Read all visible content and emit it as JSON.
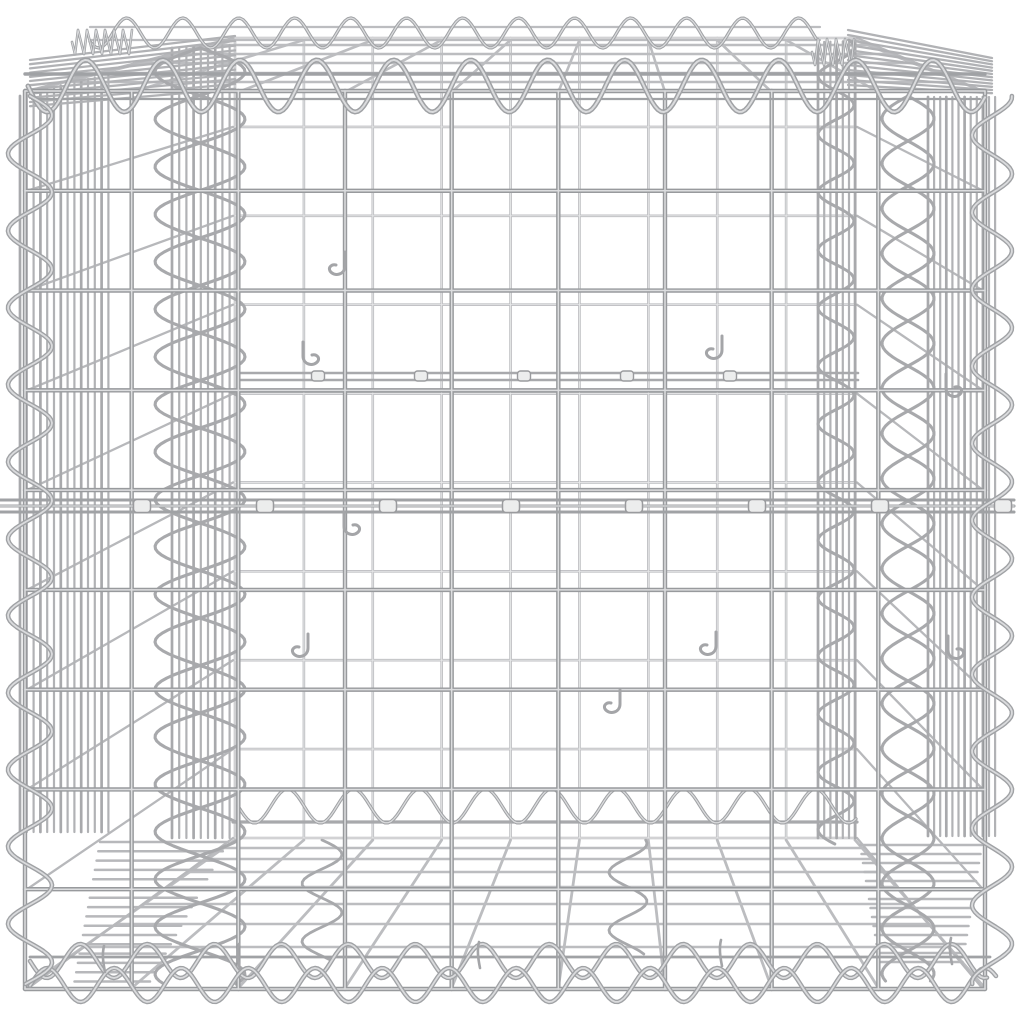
{
  "photo": {
    "subject": "galvanised-silver-wire-gabion-basket-cube",
    "background": "#ffffff",
    "colors": {
      "bg": "#ffffff",
      "front_dark": "#989a9d",
      "front_light": "#dcdddf",
      "back_main": "#bcbdc0",
      "back_light": "#e7e8e9",
      "band": "#b1b2b5",
      "panel_h": "#b7b8bb",
      "braid": "#a8a9ac",
      "spiral": "#a0a2a5",
      "spiral_light": "#dadbdd",
      "detail": "#a4a5a8",
      "clip_fill": "#eceded",
      "clip_stroke": "#9a9b9e"
    },
    "front": {
      "x0": 25,
      "x1": 985,
      "y0": 91,
      "y1": 989,
      "nx": 10,
      "ny": 10
    },
    "back": {
      "x0": 235,
      "x1": 855,
      "y0": 38,
      "y1": 838,
      "nx": 10,
      "ny": 10
    },
    "lid_rows": [
      45,
      54,
      63,
      73,
      82
    ],
    "bottom_rows": [
      848,
      859,
      872,
      887,
      904,
      924,
      947
    ],
    "rails": {
      "back_top_a": [
        90,
        27,
        820,
        2.2
      ],
      "back_top_b": [
        90,
        40,
        820,
        2.2
      ],
      "back_bottom": [
        233,
        822,
        857,
        3.2
      ],
      "front_top": [
        25,
        74,
        985,
        3.4
      ],
      "front_top2": [
        32,
        99,
        980,
        2.2
      ],
      "front_bottom": [
        30,
        957,
        990,
        2.8
      ]
    },
    "spirals": {
      "front_top": {
        "x0": 28,
        "x1": 986,
        "cy": 86,
        "amp": 26,
        "per": 77,
        "ph": 0,
        "w": 5
      },
      "back_top": {
        "x0": 90,
        "x1": 818,
        "cy": 33,
        "amp": 15,
        "per": 56,
        "ph": 0.6,
        "w": 3.3
      },
      "back_bottom": {
        "x0": 238,
        "x1": 856,
        "cy": 806,
        "amp": 17,
        "per": 66,
        "ph": 0,
        "w": 3.3
      },
      "front_bottom_a": {
        "x0": 30,
        "x1": 988,
        "cy": 961,
        "amp": 17,
        "per": 67,
        "ph": 0,
        "w": 4.5
      },
      "front_bottom_b": {
        "x0": 30,
        "x1": 996,
        "cy": 985,
        "amp": 17,
        "per": 67,
        "ph": 3.1,
        "w": 4.5
      },
      "coil_tl": {
        "x0": 72,
        "x1": 134,
        "cy": 42,
        "amp": 14,
        "per": 9,
        "ph": 0,
        "w": 2.6
      },
      "coil_tr": {
        "x0": 812,
        "x1": 856,
        "cy": 52,
        "amp": 15,
        "per": 9,
        "ph": 0,
        "w": 2.6
      },
      "front_left": {
        "cx": 30,
        "y0": 96,
        "y1": 985,
        "amp": 22,
        "per": 77,
        "ph": 0,
        "w": 4.6
      },
      "front_right": {
        "cx": 992,
        "y0": 96,
        "y1": 985,
        "amp": 20,
        "per": 77,
        "ph": 1.5,
        "w": 4.6
      }
    },
    "braids": [
      {
        "cx": 200,
        "amp": 45,
        "per": 95,
        "ph": 0,
        "y0": 48,
        "y1": 985,
        "w": 3.1
      },
      {
        "cx": 200,
        "amp": 45,
        "per": 95,
        "ph": 3.14,
        "y0": 48,
        "y1": 985,
        "w": 3.1
      },
      {
        "cx": 908,
        "amp": 26,
        "per": 90,
        "ph": 0,
        "y0": 96,
        "y1": 983,
        "w": 3.1
      },
      {
        "cx": 908,
        "amp": 26,
        "per": 90,
        "ph": 3.14,
        "y0": 96,
        "y1": 983,
        "w": 3.1
      },
      {
        "cx": 836,
        "amp": 18,
        "per": 58,
        "ph": 0.8,
        "y0": 40,
        "y1": 845,
        "w": 3.0
      },
      {
        "cx": 322,
        "amp": 20,
        "per": 58,
        "ph": 0,
        "y0": 840,
        "y1": 962,
        "w": 2.8
      },
      {
        "cx": 628,
        "amp": 19,
        "per": 58,
        "ph": 1.2,
        "y0": 840,
        "y1": 955,
        "w": 2.8
      }
    ],
    "bands": [
      {
        "x0": 20,
        "step": 6.8,
        "n": 14,
        "topA": 96,
        "topB": 74,
        "bot": 832
      },
      {
        "x0": 172,
        "step": 7.2,
        "n": 9,
        "topA": 48,
        "topB": 45,
        "bot": 838
      },
      {
        "x0": 928,
        "step": 6.1,
        "n": 12,
        "topA": 97,
        "topB": 97,
        "bot": 836
      },
      {
        "x0": 818,
        "step": 6.2,
        "n": 7,
        "topA": 42,
        "topB": 41,
        "bot": 838
      }
    ],
    "wedges": {
      "tl": {
        "n": 12,
        "xA": 235,
        "yA0": 36,
        "dyA": 4.8,
        "xB": 30,
        "yB0": 60,
        "dyB": 4.2,
        "w": 2.3
      },
      "tr": {
        "n": 12,
        "xA": 848,
        "yA0": 30,
        "dyA": 5.0,
        "xB": 992,
        "yB0": 58,
        "dyB": 3.2,
        "w": 2.3
      }
    },
    "ladders": {
      "bl": {
        "n": 16,
        "y0": 842,
        "dy": 9.3,
        "xr0": 228,
        "dxr": -5.2,
        "len0": 128,
        "dlen": -3.5,
        "w": 2.5
      },
      "br": {
        "n": 14,
        "y0": 845,
        "dy": 9.0,
        "xl0": 860,
        "dxl": 1.5,
        "len0": 122,
        "dlen": -3.0,
        "w": 2.5
      }
    },
    "belt": {
      "x0": 0,
      "x1": 1014,
      "ys": [
        500,
        506,
        512
      ],
      "w": 3.1,
      "clip_y": 506,
      "clip_w": 17,
      "clip_h": 13,
      "clip_xs": [
        142,
        265,
        388,
        511,
        634,
        757,
        880,
        1003
      ]
    },
    "tie": {
      "x0": 240,
      "x1": 858,
      "ys": [
        373,
        380
      ],
      "w": 2.6,
      "clip_y": 376,
      "clip_w": 13,
      "clip_h": 10,
      "clip_xs": [
        318,
        421,
        524,
        627,
        730
      ]
    },
    "hooks": [
      [
        345,
        268,
        1
      ],
      [
        303,
        358,
        -1
      ],
      [
        722,
        352,
        1
      ],
      [
        946,
        390,
        -1
      ],
      [
        344,
        528,
        -1
      ],
      [
        308,
        650,
        1
      ],
      [
        948,
        652,
        -1
      ],
      [
        620,
        706,
        1
      ],
      [
        716,
        648,
        1
      ]
    ],
    "prongs": [
      [
        105,
        972
      ],
      [
        240,
        970
      ],
      [
        480,
        968
      ],
      [
        722,
        966
      ],
      [
        952,
        964
      ]
    ]
  }
}
